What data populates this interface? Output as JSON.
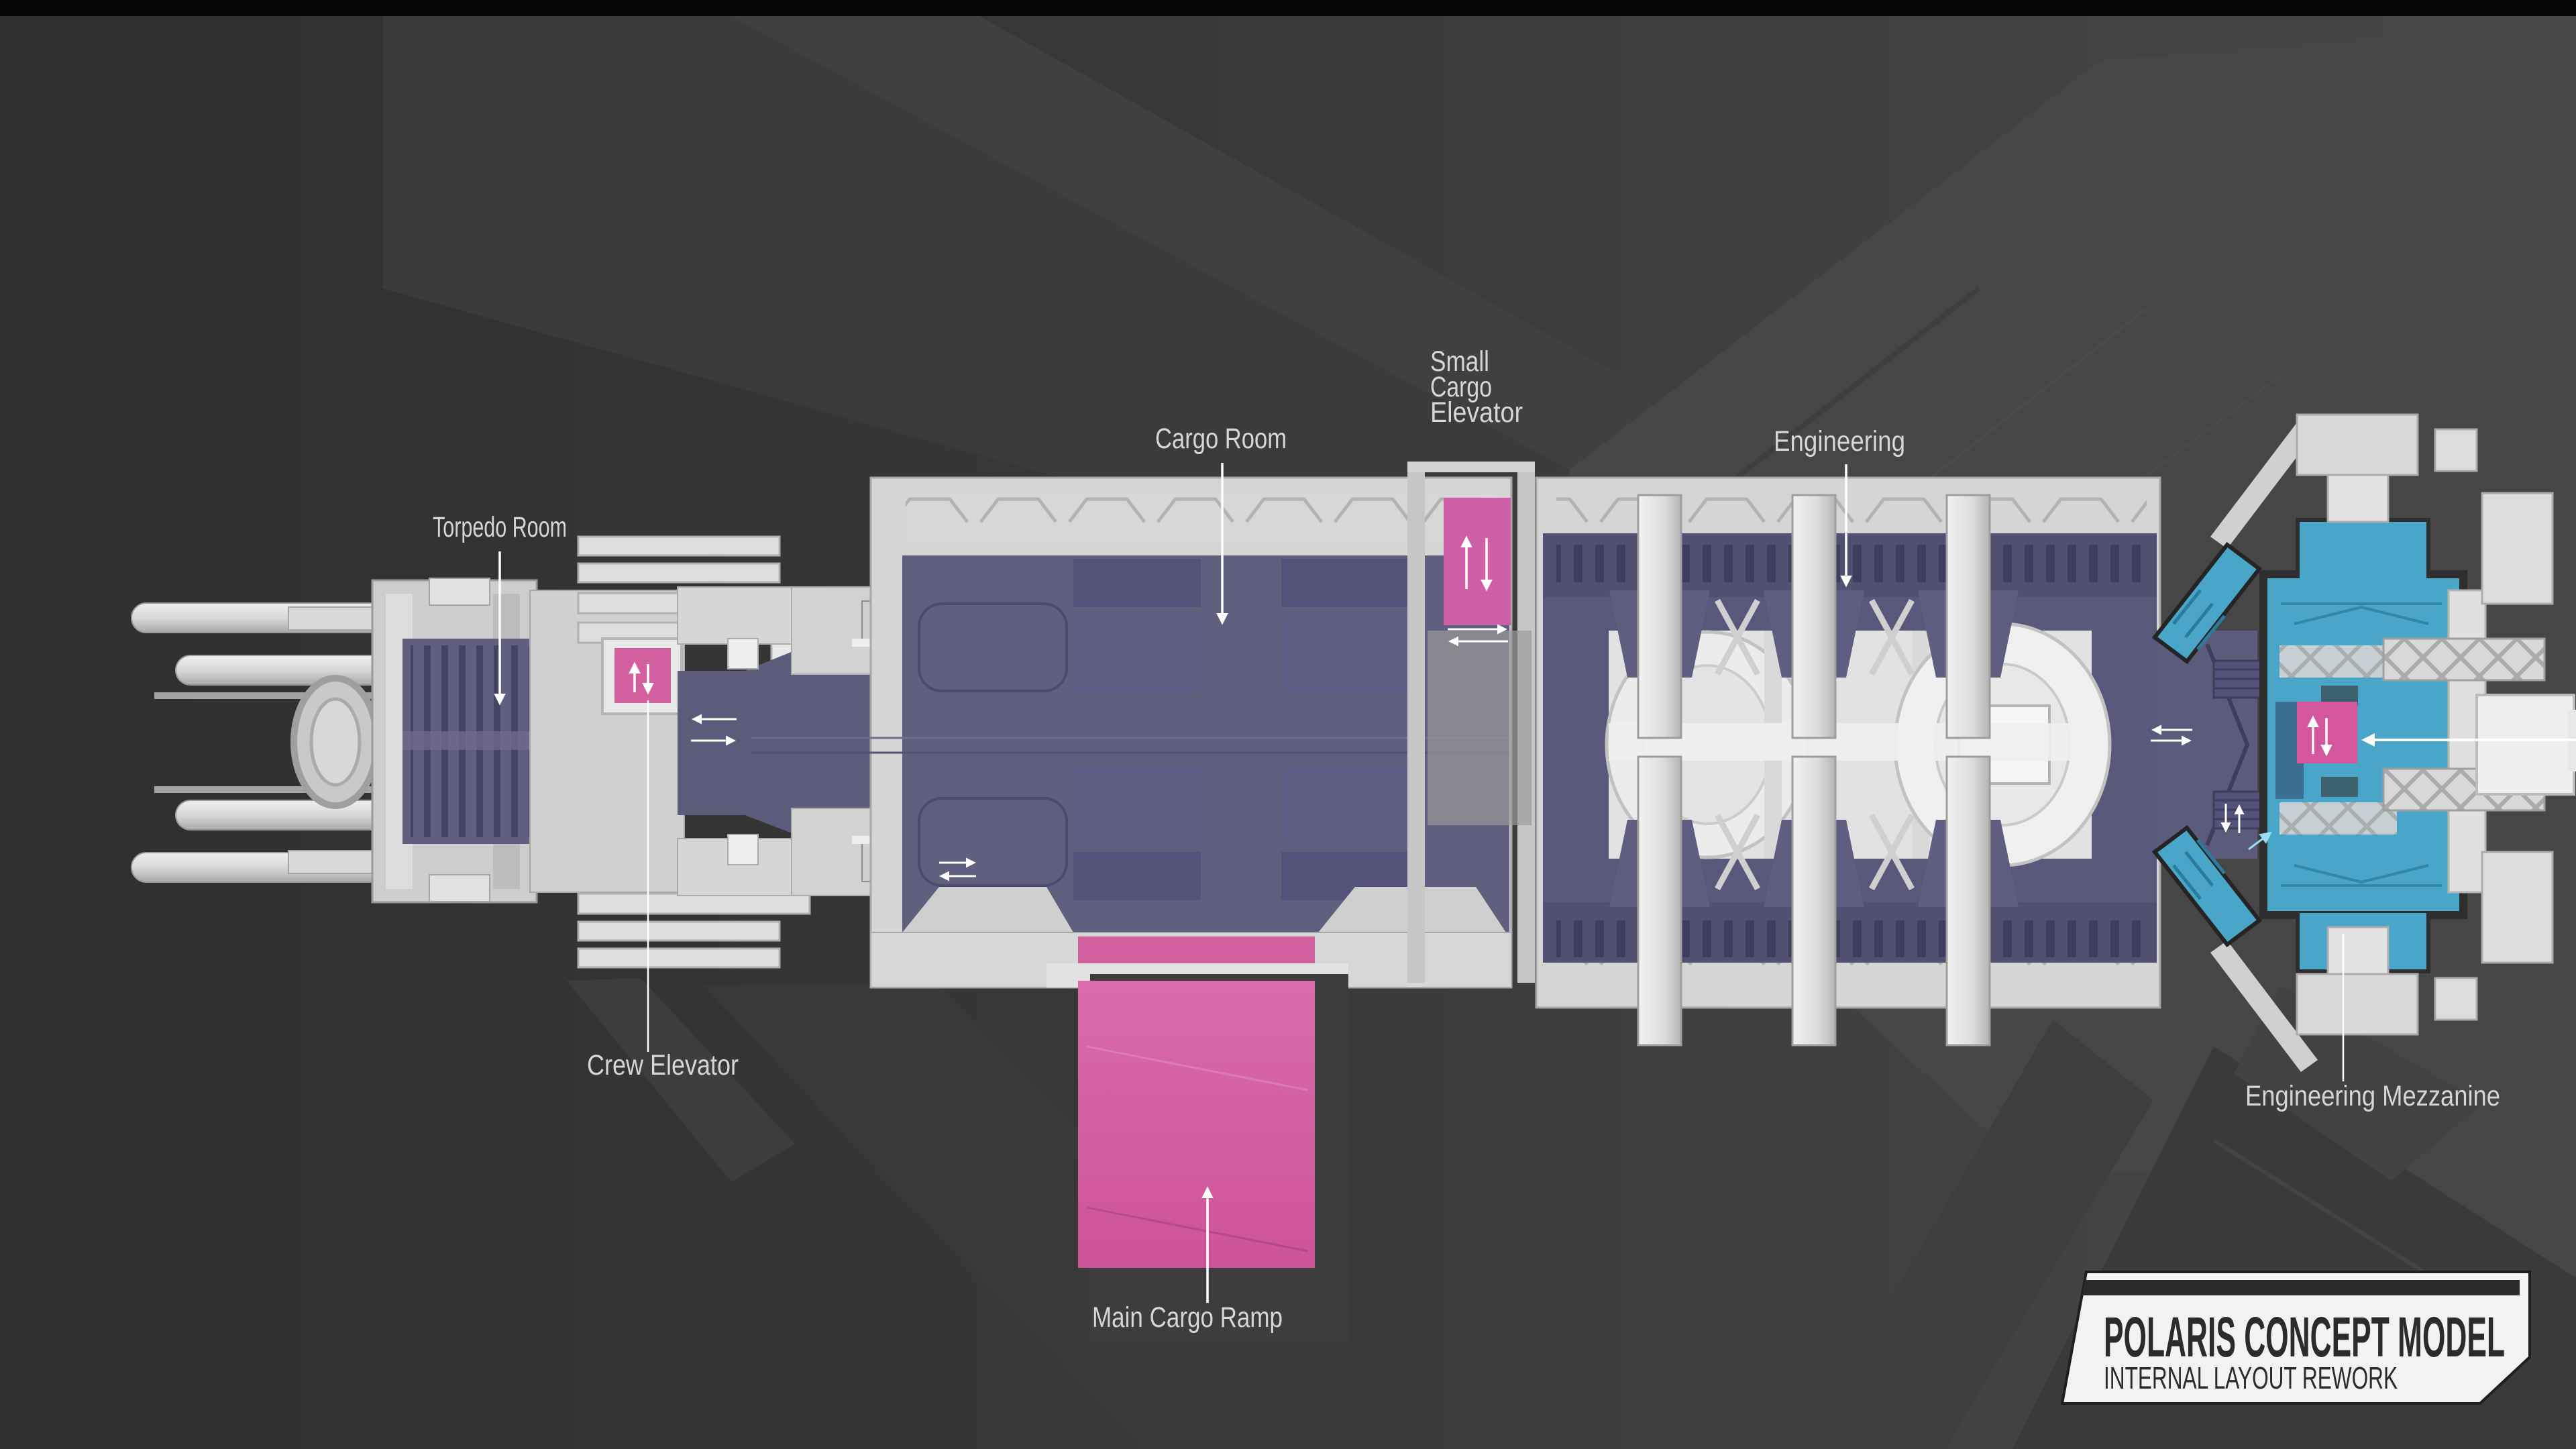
{
  "annotations": {
    "torpedo_room": "Torpedo Room",
    "crew_elevator": "Crew Elevator",
    "cargo_room": "Cargo Room",
    "small_cargo_elevator_line1": "Small",
    "small_cargo_elevator_line2": "Cargo",
    "small_cargo_elevator_line3": "Elevator",
    "engineering": "Engineering",
    "engineering_mezzanine": "Engineering Mezzanine",
    "main_cargo_ramp": "Main Cargo Ramp"
  },
  "title_plate": {
    "title": "POLARIS CONCEPT MODEL",
    "subtitle": "INTERNAL LAYOUT REWORK"
  },
  "icons": {
    "elevator-up-arrow-icon": "↑",
    "elevator-down-arrow-icon": "↓",
    "door-left-arrow-icon": "←",
    "door-right-arrow-icon": "→",
    "pointer-down-arrow-icon": "↓",
    "pointer-up-arrow-icon": "↑",
    "pointer-left-arrow-icon": "←",
    "stairs-up-arrow-icon": "↗"
  },
  "colors": {
    "background": "#373737",
    "background_dark": "#2c2c2c",
    "background_panel": "#454545",
    "top_bar": "#060606",
    "hull": "#d5d5d5",
    "hull_light": "#ececec",
    "hull_shadow": "#b3b3b3",
    "room_purple": "#615f7e",
    "room_purple_dark": "#454363",
    "crate_purple": "#55527a",
    "pink": "#d2609f",
    "pink_ramp": "#d25d9f",
    "cyan": "#4aa6c8",
    "cyan_dark": "#2f87a8",
    "label": "#d6d6d6",
    "plate": "#f2f2f2",
    "plate_text": "#2b2b2b"
  }
}
